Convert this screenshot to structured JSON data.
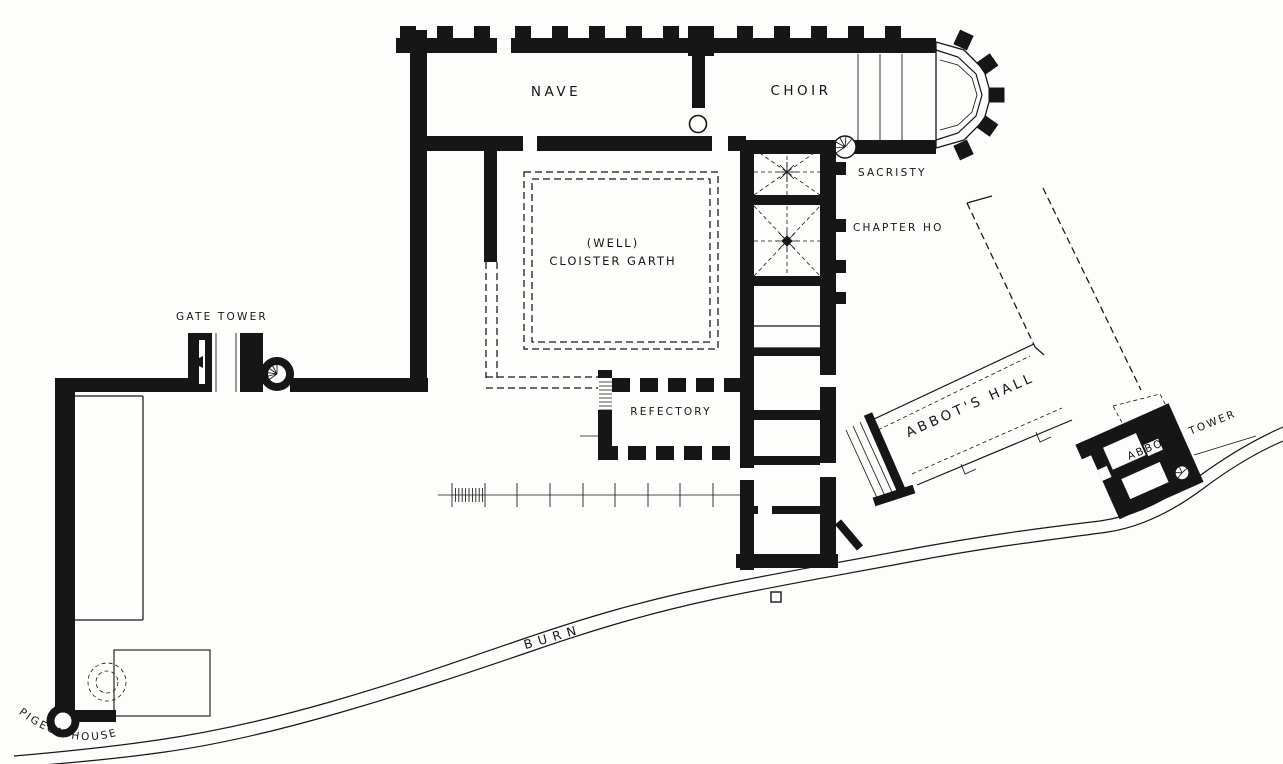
{
  "figure": {
    "kind": "abbey-floor-plan",
    "ink_color": "#161616",
    "paper_color": "#fdfdfb"
  },
  "labels": {
    "church": {
      "nave": "NAVE",
      "choir": "CHOIR",
      "sacristy": "SACRISTY",
      "chapter_house": "CHAPTER HO"
    },
    "cloister": {
      "well": "(WELL)",
      "garth": "CLOISTER GARTH"
    },
    "south_range": {
      "refectory": "REFECTORY"
    },
    "precinct": {
      "gate_tower": "GATE TOWER",
      "pigeon_house": "PIGEON HOUSE"
    },
    "abbots_buildings": {
      "hall": "ABBOT'S HALL",
      "tower": "ABBOT'S TOWER"
    },
    "landscape": {
      "burn": "BURN"
    }
  }
}
